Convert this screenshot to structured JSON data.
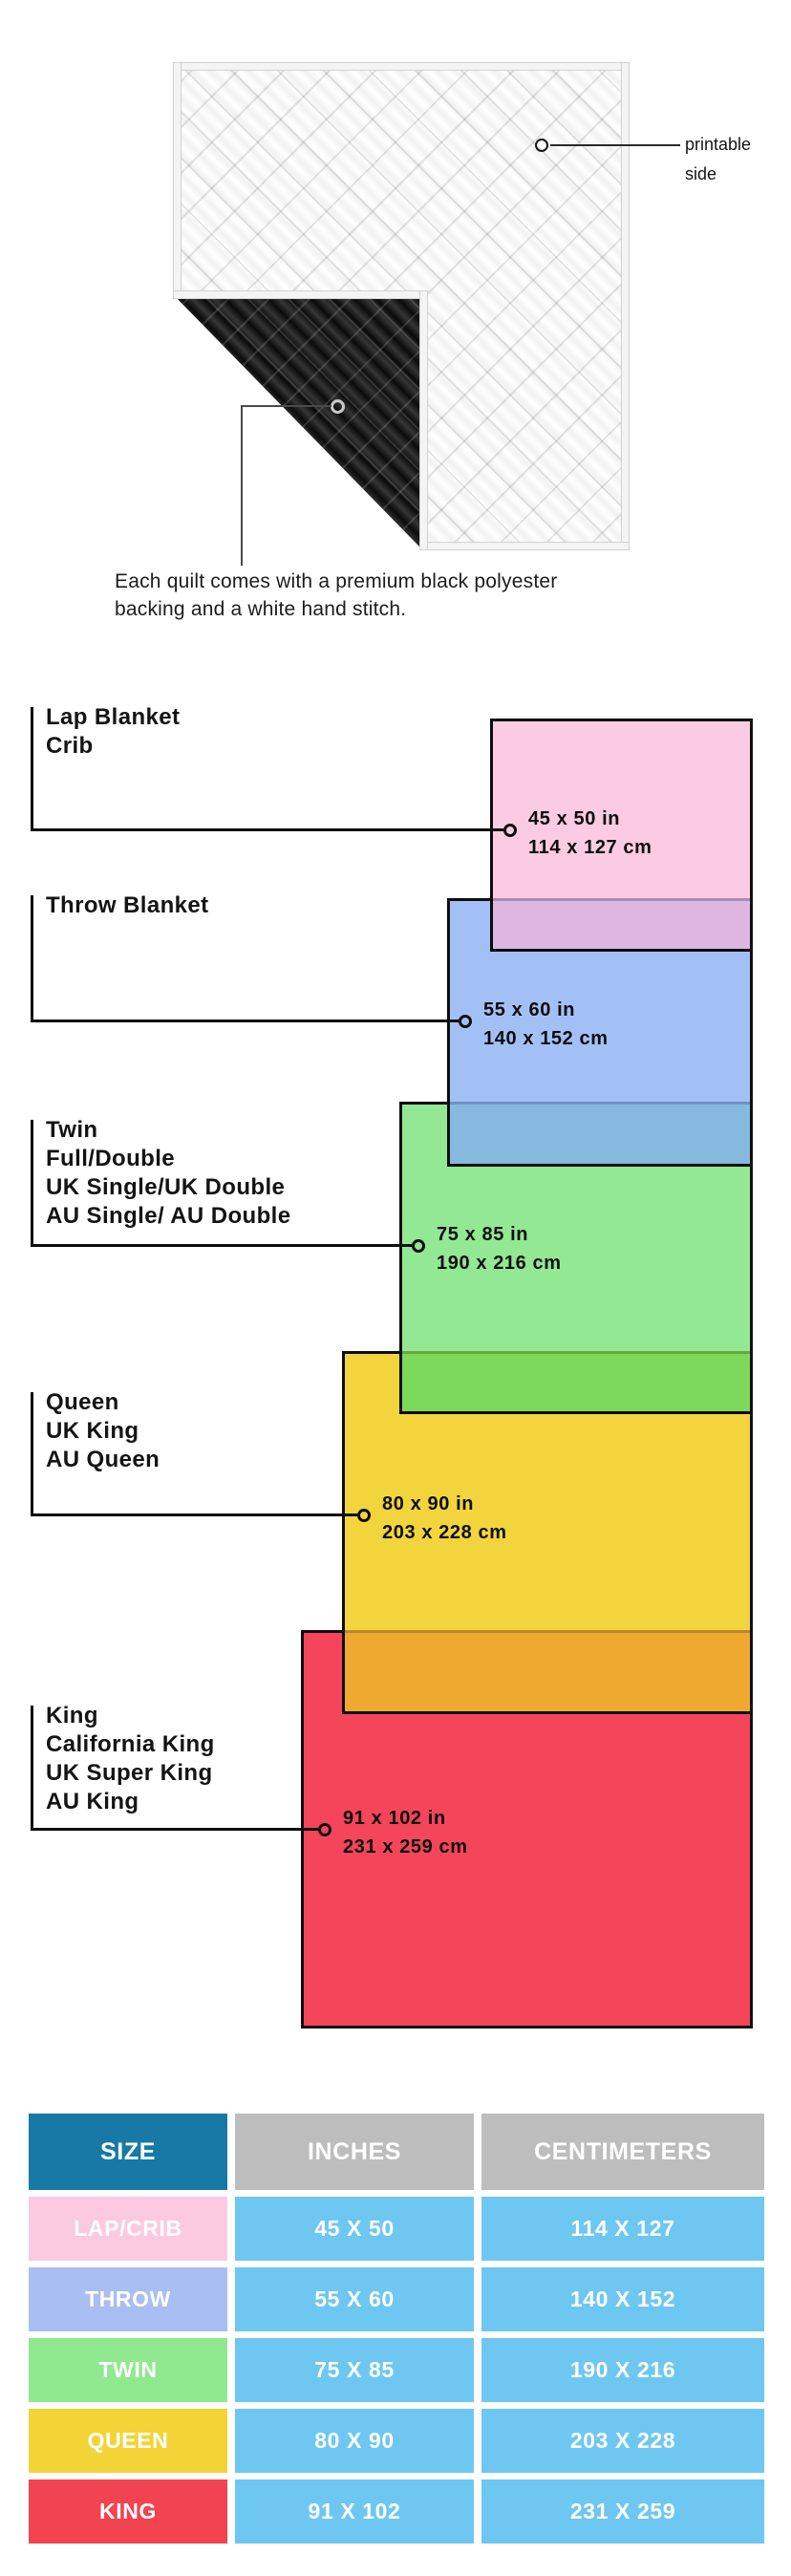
{
  "hero": {
    "printable_side_label": "printable side",
    "caption": "Each quilt comes with a premium black polyester backing and a white hand stitch."
  },
  "diagram": {
    "items": [
      {
        "names": [
          "Lap Blanket",
          "Crib"
        ],
        "inches": "45 x 50 in",
        "cm": "114 x 127 cm",
        "color": "#facbe3"
      },
      {
        "names": [
          "Throw Blanket"
        ],
        "inches": "55 x 60 in",
        "cm": "140 x 152 cm",
        "color": "#a3c0f6"
      },
      {
        "names": [
          "Twin",
          "Full/Double",
          "UK Single/UK Double",
          "AU Single/ AU Double"
        ],
        "inches": "75 x 85 in",
        "cm": "190 x 216 cm",
        "color": "#92e893"
      },
      {
        "names": [
          "Queen",
          "UK King",
          "AU Queen"
        ],
        "inches": "80 x 90 in",
        "cm": "203 x 228 cm",
        "color": "#f2d53d"
      },
      {
        "names": [
          "King",
          "California King",
          "UK Super King",
          "AU King"
        ],
        "inches": "91 x 102 in",
        "cm": "231 x 259 cm",
        "color": "#f4455a"
      }
    ],
    "overlap_colors": [
      "#deb6e2",
      "#85b9de",
      "#7dd95a",
      "#f0a930"
    ]
  },
  "table": {
    "headers": [
      "SIZE",
      "INCHES",
      "CENTIMETERS"
    ],
    "rows": [
      {
        "size": "LAP/CRIB",
        "inches": "45 X 50",
        "cm": "114 X 127",
        "color": "#fbcae1"
      },
      {
        "size": "THROW",
        "inches": "55 X 60",
        "cm": "140 X 152",
        "color": "#a9bef2"
      },
      {
        "size": "TWIN",
        "inches": "75 X 85",
        "cm": "190 X 216",
        "color": "#90e98f"
      },
      {
        "size": "QUEEN",
        "inches": "80 X 90",
        "cm": "203 X 228",
        "color": "#f2d437"
      },
      {
        "size": "KING",
        "inches": "91 X 102",
        "cm": "231 X 259",
        "color": "#f24350"
      }
    ]
  }
}
